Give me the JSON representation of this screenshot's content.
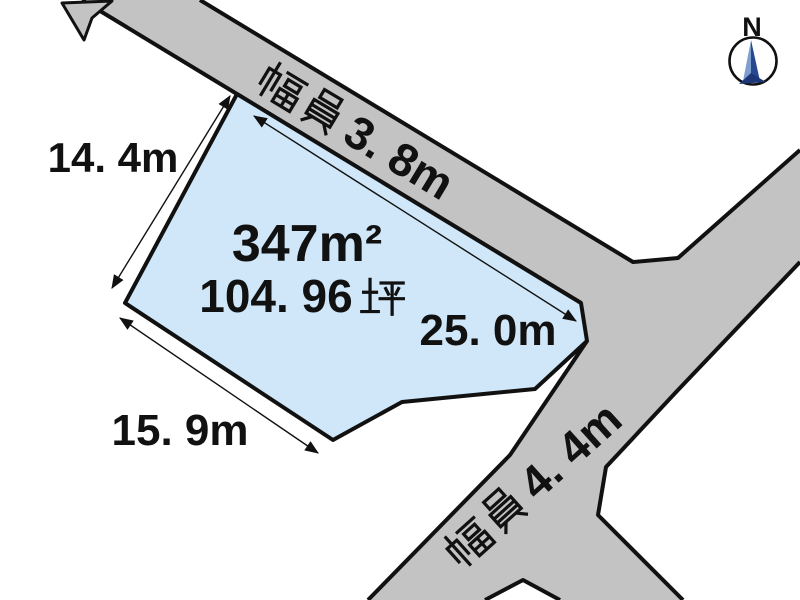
{
  "diagram": {
    "type": "land-plot-diagram",
    "background": "#ffffff",
    "outline_color": "#111111",
    "parcel": {
      "fill": "#cfe7f8",
      "area_m2": "347m²",
      "area_tsubo": "104. 96坪",
      "area_tsubo_number": "104. 96"
    },
    "roads": {
      "fill": "#c3c3c3",
      "top_road": {
        "label": "幅員3. 8m",
        "label_suffix": "3. 8m"
      },
      "right_road": {
        "label": "幅員4. 4m",
        "label_suffix": "4. 4m"
      }
    },
    "dimensions": {
      "west": {
        "label": "14. 4m"
      },
      "frontage": {
        "label": "25. 0m"
      },
      "southwest": {
        "label": "15. 9m"
      }
    },
    "compass": {
      "label": "N",
      "needle_light": "#7f9fd0",
      "needle_dark": "#27478f",
      "needle_base": "#1c3677"
    }
  }
}
